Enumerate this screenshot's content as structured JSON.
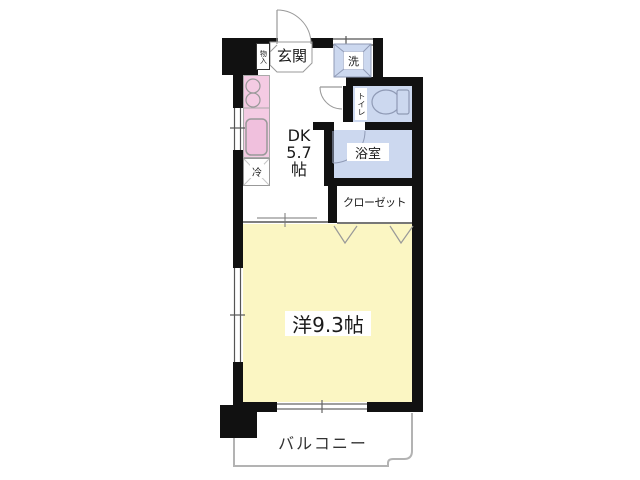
{
  "title": "apartment-floor-plan",
  "colors": {
    "wall": "#111111",
    "kitchen_pink": "#f4cbe3",
    "sink_pink": "#f0c0dd",
    "wet_blue": "#ccd8ef",
    "room_yellow": "#fbf6c3",
    "line_gray": "#999999",
    "balcony_gray": "#b3b3b3"
  },
  "rooms": {
    "genkan": {
      "label": "玄関"
    },
    "storage": {
      "label": "物入"
    },
    "laundry": {
      "label": "洗"
    },
    "toilet": {
      "label": "トイレ"
    },
    "bathroom": {
      "label": "浴室"
    },
    "dining_kitchen": {
      "label_lines": [
        "DK",
        "5.7",
        "帖"
      ],
      "size_tatami": "5.7"
    },
    "fridge": {
      "label": "冷"
    },
    "closet": {
      "label": "クローゼット"
    },
    "western_room": {
      "label": "洋9.3帖",
      "size_tatami": "9.3"
    },
    "balcony": {
      "label": "バルコニー"
    }
  }
}
